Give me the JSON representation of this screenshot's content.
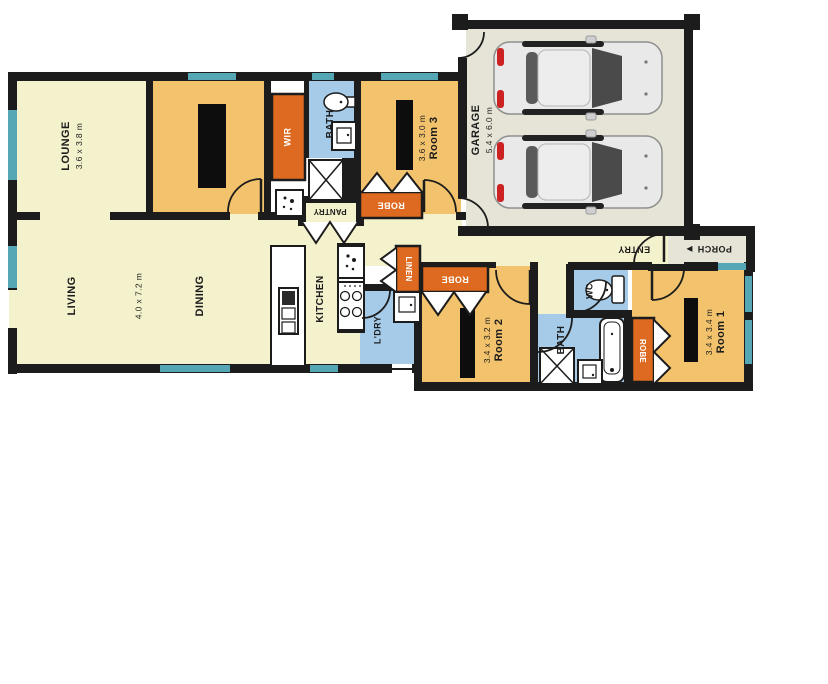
{
  "plan_title": "residential-floor-plan",
  "rooms": {
    "lounge": {
      "label": "LOUNGE",
      "dims": "3.6 x 3.8 m"
    },
    "living": {
      "label": "LIVING",
      "dims": "4.0 x 7.2 m"
    },
    "dining": {
      "label": "DINING"
    },
    "kitchen": {
      "label": "KITCHEN"
    },
    "wir": {
      "label": "WIR"
    },
    "bath_ensuite": {
      "label": "BATH"
    },
    "room3": {
      "label": "Room 3",
      "dims": "3.6 x 3.0 m"
    },
    "robe_room3": {
      "label": "ROBE"
    },
    "pantry": {
      "label": "PANTRY"
    },
    "garage": {
      "label": "GARAGE",
      "dims": "5.4 x 6.0 m"
    },
    "linen": {
      "label": "LINEN"
    },
    "laundry": {
      "label": "L'DRY"
    },
    "robe_room2": {
      "label": "ROBE"
    },
    "room2": {
      "label": "Room 2",
      "dims": "3.4 x 3.2 m"
    },
    "wc": {
      "label": "WC"
    },
    "bath_main": {
      "label": "BATH"
    },
    "robe_room1": {
      "label": "ROBE"
    },
    "room1": {
      "label": "Room 1",
      "dims": "3.4 x 3.4 m"
    },
    "entry": {
      "label": "ENTRY"
    },
    "porch": {
      "label": "PORCH",
      "arrow": "►"
    }
  },
  "colors": {
    "wall": "#1c1c1c",
    "floor_pale": "#f4f1cd",
    "bedroom_orange": "#f2c36c",
    "robe_orange": "#dd6a20",
    "wet_blue": "#a6cbe9",
    "window_teal": "#55a7b5",
    "garage_grey": "#e6e4d6",
    "fixture_white": "#ffffff"
  }
}
